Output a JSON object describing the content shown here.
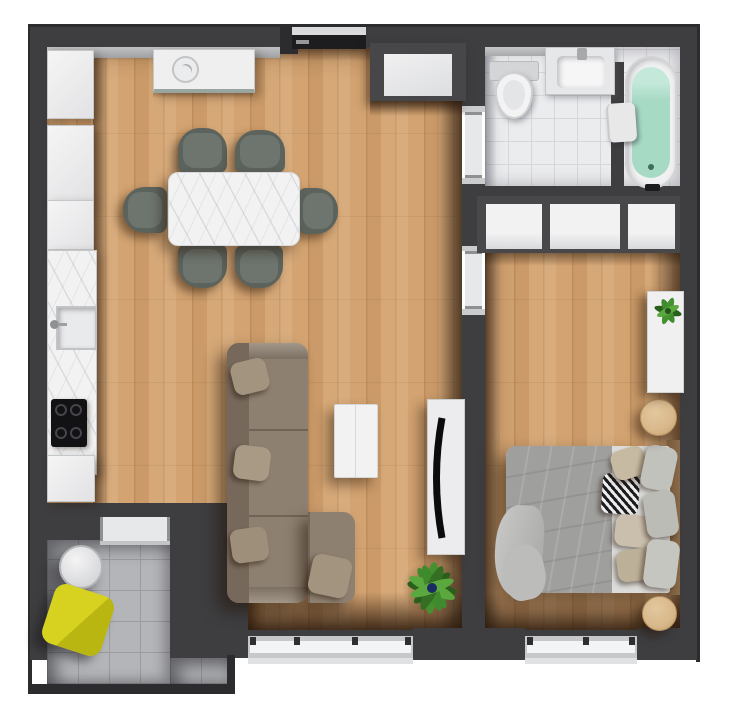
{
  "palette": {
    "wall": "#3e3e41",
    "wall-dark": "#2c2c2f",
    "wall-light": "#b7b8ba",
    "wood-base": "#d3a371",
    "bath-tile": "#ebecee",
    "bath-line": "#d6d7d9",
    "balcony-tile": "#b4b5b8",
    "balcony-line": "#9b9c9f",
    "furniture-white": "#efeff0",
    "frame-gray": "#c6c7c9",
    "marble-white": "#f2f2f3",
    "chair-green": "#5c635d",
    "chair-cushion": "#6e756f",
    "sofa-taupe": "#8e8070",
    "sofa-back": "#76685a",
    "sofa-pillow": "#a2947e",
    "bed-blanket": "#9f9f9d",
    "bed-sheet": "#dcdcda",
    "pillow-beige": "#c6baa2",
    "pillow-gray": "#c2c2bd",
    "tub-water": "#a7dac5",
    "plant-green": "#3f8a2c",
    "plant-dark": "#2a5e1b",
    "flower-blue": "#1b2a63",
    "chair-yellow": "#cbc817",
    "nightstand-wood": "#d8b88b",
    "window-white": "#f3f4f5",
    "window-frame": "#c7c8ca",
    "door-dark": "#1d1d20",
    "door-light": "#e7e8ea",
    "headboard-wood": "#8a6b4a",
    "cooktop-black": "#121215",
    "towel-white": "#e8e8e9"
  },
  "floorplan": {
    "view": "top-down-3d-render",
    "rooms": [
      {
        "name": "living-room-kitchen",
        "floor": "wood-planks"
      },
      {
        "name": "entry-hall",
        "floor": "wood-planks"
      },
      {
        "name": "bathroom",
        "floor": "white-tile"
      },
      {
        "name": "bedroom",
        "floor": "wood-planks"
      },
      {
        "name": "balcony",
        "floor": "gray-tile"
      }
    ],
    "furniture": {
      "kitchen": [
        "wall-cabinet-run",
        "marble-counter",
        "kitchen-sink",
        "induction-cooktop-4-burners",
        "base-cabinet",
        "sideboard-with-plate"
      ],
      "living_room": [
        "dining-table-marble",
        "dining-chairs-x6",
        "l-shaped-sofa-with-pillows",
        "coffee-table",
        "tv-stand",
        "curved-tv",
        "potted-plant"
      ],
      "entry_hall": [
        "entrance-door",
        "entry-closet"
      ],
      "bathroom": [
        "toilet",
        "washbasin-vanity",
        "bathtub-filled",
        "towel",
        "partition-wall"
      ],
      "bedroom": [
        "wardrobe-3-sections",
        "double-bed",
        "pillows-x7",
        "patterned-pillow",
        "round-nightstand-x2",
        "wall-shelf-with-plant"
      ],
      "balcony": [
        "round-table",
        "yellow-lounge-chair",
        "railing"
      ]
    },
    "counts": {
      "dining_chairs": 6,
      "wardrobe_sections": 3,
      "bed_pillow_groups": 7,
      "windows": 2,
      "interior_doors": 3
    }
  }
}
